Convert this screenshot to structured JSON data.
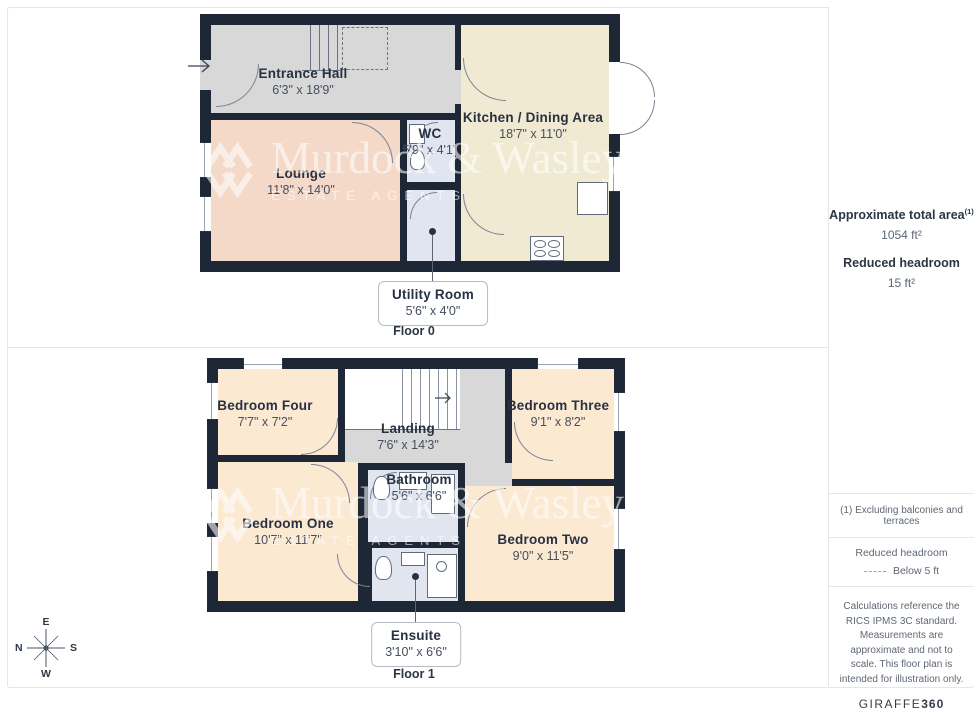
{
  "watermark": {
    "line1": "Murdock & Wasley",
    "line2": "ESTATE AGENTS"
  },
  "floor0": {
    "label": "Floor 0",
    "rooms": [
      {
        "name": "Entrance Hall",
        "dims": "6'3\" x 18'9\""
      },
      {
        "name": "Lounge",
        "dims": "11'8\" x 14'0\""
      },
      {
        "name": "WC",
        "dims": "5'9\" x 4'1\""
      },
      {
        "name": "Kitchen / Dining Area",
        "dims": "18'7\" x 11'0\""
      }
    ],
    "callout": {
      "name": "Utility Room",
      "dims": "5'6\" x 4'0\""
    }
  },
  "floor1": {
    "label": "Floor 1",
    "rooms": [
      {
        "name": "Bedroom Four",
        "dims": "7'7\" x 7'2\""
      },
      {
        "name": "Landing",
        "dims": "7'6\" x 14'3\""
      },
      {
        "name": "Bedroom Three",
        "dims": "9'1\" x 8'2\""
      },
      {
        "name": "Bathroom",
        "dims": "5'6\" x 6'6\""
      },
      {
        "name": "Bedroom One",
        "dims": "10'7\" x 11'7\""
      },
      {
        "name": "Bedroom Two",
        "dims": "9'0\" x 11'5\""
      }
    ],
    "callout": {
      "name": "Ensuite",
      "dims": "3'10\" x 6'6\""
    }
  },
  "sidebar": {
    "total_area_label": "Approximate total area",
    "total_area_superscript": "(1)",
    "total_area_value": "1054 ft²",
    "reduced_headroom_label": "Reduced headroom",
    "reduced_headroom_value": "15 ft²",
    "footnote": "(1) Excluding balconies and terraces",
    "legend_title": "Reduced headroom",
    "legend_value": "Below 5 ft",
    "disclaimer": "Calculations reference the RICS IPMS 3C standard. Measurements are approximate and not to scale. This floor plan is intended for illustration only.",
    "brand": "GIRAFFE",
    "brand_suffix": "360"
  },
  "compass": {
    "top": "E",
    "right": "S",
    "bottom": "W",
    "left": "N"
  },
  "palette": {
    "wall": "#1e2735",
    "hall": "#d8d8d8",
    "lounge": "#f4d9c8",
    "kitchen": "#f1ead3",
    "bedroom": "#fce9d2",
    "wet_room": "#e0e5f0"
  }
}
